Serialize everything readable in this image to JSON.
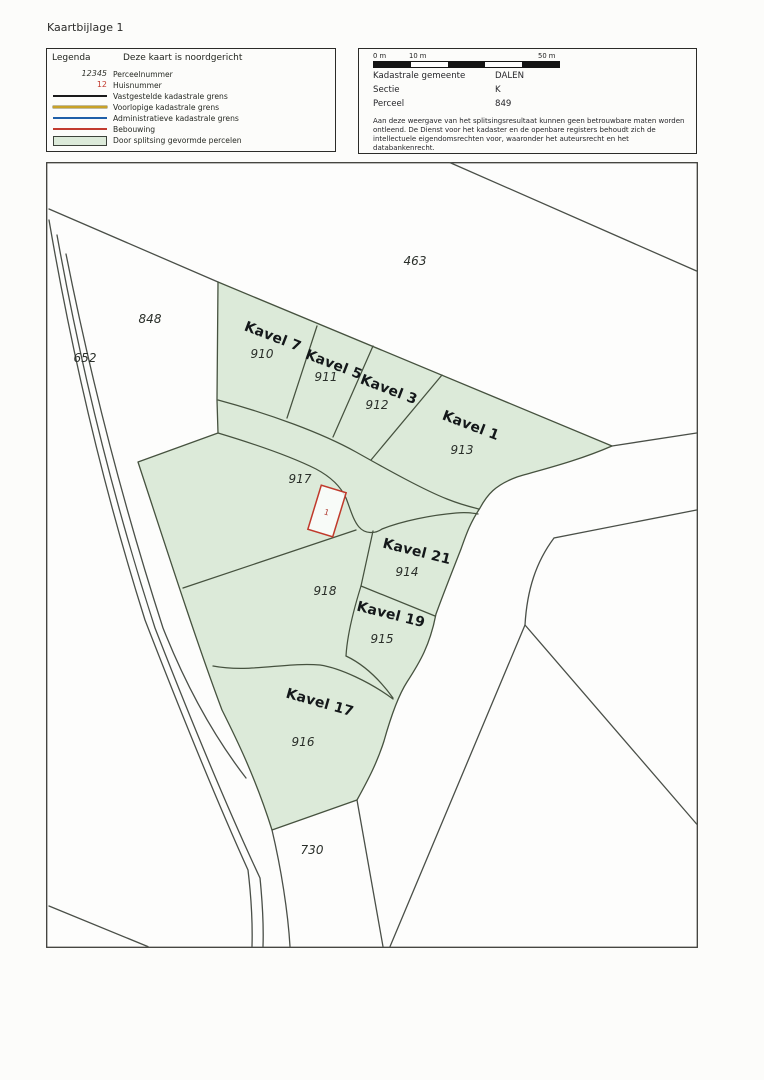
{
  "page": {
    "title": "Kaartbijlage 1"
  },
  "legend": {
    "title": "Legenda",
    "north_note": "Deze kaart is noordgericht",
    "items": [
      {
        "symbol": "parcel-number-sample",
        "sample": "12345",
        "label": "Perceelnummer"
      },
      {
        "symbol": "house-number-sample",
        "sample": "12",
        "label": "Huisnummer",
        "color": "#c23b2e"
      },
      {
        "symbol": "line-established",
        "label": "Vastgestelde kadastrale grens",
        "color": "#1a1a1a"
      },
      {
        "symbol": "line-provisional",
        "label": "Voorlopige kadastrale grens",
        "color": "#c9a227"
      },
      {
        "symbol": "line-administrative",
        "label": "Administratieve kadastrale grens",
        "color": "#1f5fa8"
      },
      {
        "symbol": "line-building",
        "label": "Bebouwing",
        "color": "#c23b2e"
      },
      {
        "symbol": "area-split-parcels",
        "label": "Door splitsing gevormde percelen",
        "color": "#dcead9"
      }
    ]
  },
  "info": {
    "scalebar": {
      "start_label": "0 m",
      "mid_label": "10 m",
      "end_label": "50 m"
    },
    "fields": [
      {
        "label": "Kadastrale gemeente",
        "value": "DALEN"
      },
      {
        "label": "Sectie",
        "value": "K"
      },
      {
        "label": "Perceel",
        "value": "849"
      }
    ],
    "disclaimer_line1": "Aan deze weergave van het splitsingsresultaat kunnen geen betrouwbare maten worden ontleend.",
    "disclaimer_line2": "De Dienst voor het kadaster en de openbare registers behoudt zich de intellectuele eigendomsrechten voor, waaronder het auteursrecht en het databankenrecht."
  },
  "map": {
    "green_fill": "#dcead9",
    "kavels": {
      "kavel7": {
        "name": "Kavel 7",
        "parcel": "910"
      },
      "kavel5": {
        "name": "Kavel 5",
        "parcel": "911"
      },
      "kavel3": {
        "name": "Kavel 3",
        "parcel": "912"
      },
      "kavel1": {
        "name": "Kavel 1",
        "parcel": "913"
      },
      "kavel21": {
        "name": "Kavel 21",
        "parcel": "914"
      },
      "kavel19": {
        "name": "Kavel 19",
        "parcel": "915"
      },
      "kavel17": {
        "name": "Kavel 17",
        "parcel": "916"
      }
    },
    "parcels": {
      "p463": "463",
      "p848": "848",
      "p652": "652",
      "p730": "730",
      "p917": "917",
      "p918": "918"
    },
    "building": {
      "house_number": "1"
    }
  }
}
